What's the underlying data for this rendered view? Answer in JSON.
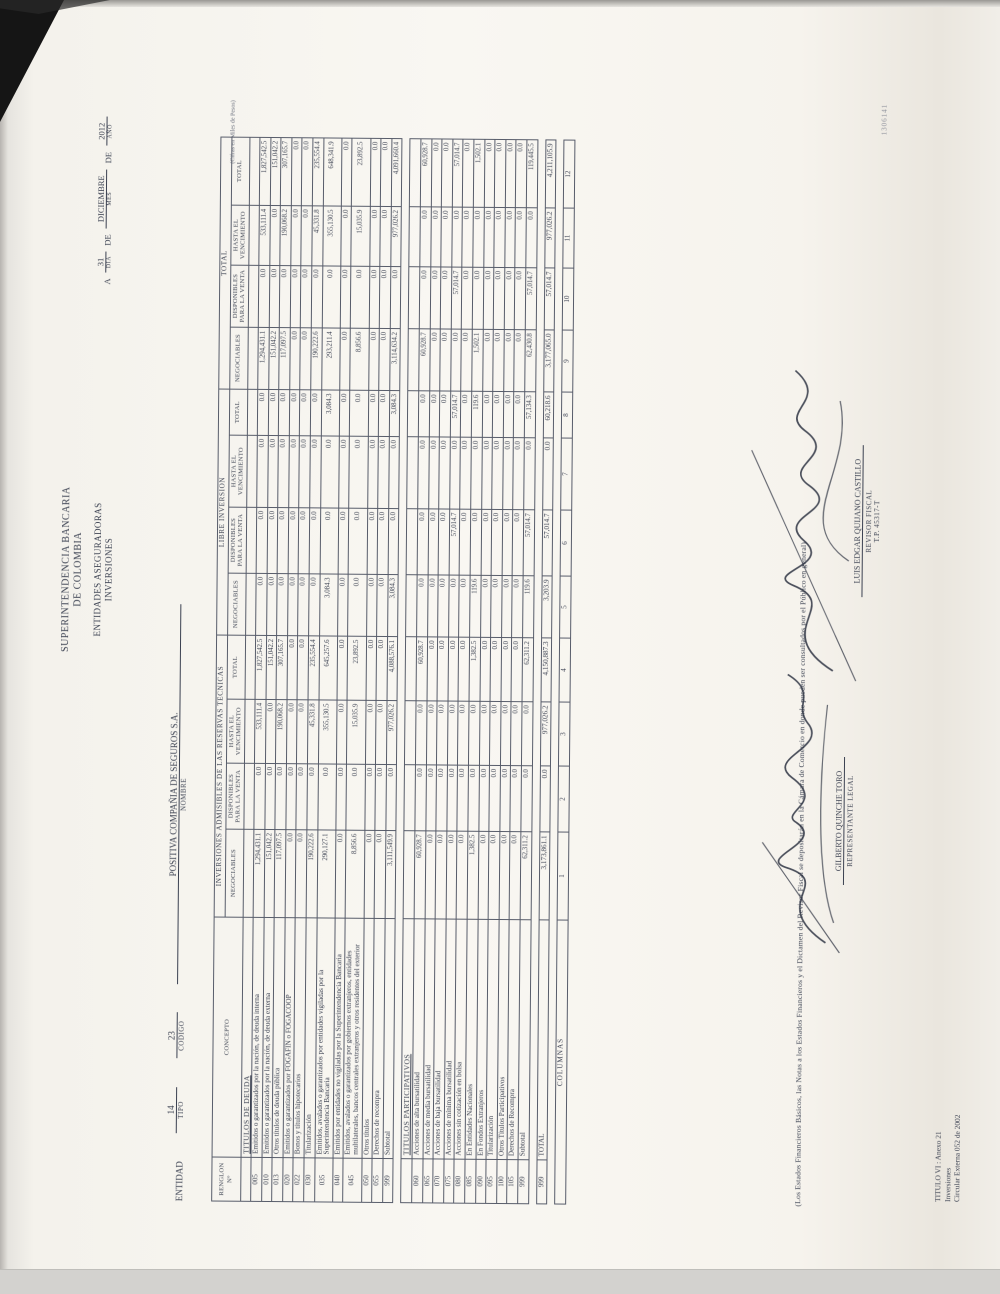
{
  "colors": {
    "ink": "#3a4050",
    "paper": "#f9f7f2"
  },
  "header": {
    "authority_line1": "SUPERINTENDENCIA BANCARIA",
    "authority_line2": "DE COLOMBIA",
    "subtitle1": "ENTIDADES ASEGURADORAS",
    "subtitle2": "INVERSIONES",
    "date": {
      "prefix": "A",
      "day": "31",
      "de1": "DE",
      "month": "DICIEMBRE",
      "de2": "DE",
      "year": "2012",
      "day_label": "DIA",
      "month_label": "MES",
      "year_label": "AÑO"
    },
    "entity": {
      "entidad_label": "ENTIDAD",
      "tipo_label": "TIPO",
      "tipo": "14",
      "codigo_label": "CODIGO",
      "codigo": "23",
      "nombre": "POSITIVA COMPAÑIA DE SEGUROS S.A.",
      "nombre_label": "NOMBRE"
    }
  },
  "table": {
    "renglon_header": "RENGLON N°",
    "concepto_header": "CONCEPTO",
    "units_note": "(Cifras en Miles de Pesos)",
    "groups": [
      {
        "label": "INVERSIONES ADMISIBLES DE LAS RESERVAS TECNICAS"
      },
      {
        "label": "LIBRE INVERSION"
      },
      {
        "label": "TOTAL"
      }
    ],
    "subheaders": [
      "NEGOCIABLES",
      "DISPONIBLES PARA LA VENTA",
      "HASTA EL VENCIMIENTO",
      "TOTAL",
      "NEGOCIABLES",
      "DISPONIBLES PARA LA VENTA",
      "HASTA EL VENCIMIENTO",
      "TOTAL",
      "NEGOCIABLES",
      "DISPONIBLES PARA LA VENTA",
      "HASTA EL VENCIMIENTO",
      "TOTAL"
    ],
    "sections": [
      {
        "title": "TITULOS DE DEUDA",
        "rows": [
          {
            "code": "005",
            "concept": "Emitidos o garantizados por la nación, de deuda interna",
            "values": [
              "1,294,431.1",
              "0.0",
              "533,111.4",
              "1,827,542.5",
              "0.0",
              "0.0",
              "0.0",
              "0.0",
              "1,294,431.1",
              "0.0",
              "533,111.4",
              "1,827,542.5"
            ]
          },
          {
            "code": "010",
            "concept": "Emitidos o garantizados por la nación, de deuda externa",
            "values": [
              "151,042.2",
              "0.0",
              "0.0",
              "151,042.2",
              "0.0",
              "0.0",
              "0.0",
              "0.0",
              "151,042.2",
              "0.0",
              "0.0",
              "151,042.2"
            ]
          },
          {
            "code": "013",
            "concept": "Otros títulos de deuda pública",
            "values": [
              "117,097.5",
              "0.0",
              "190,068.2",
              "307,165.7",
              "0.0",
              "0.0",
              "0.0",
              "0.0",
              "117,097.5",
              "0.0",
              "190,068.2",
              "307,165.7"
            ]
          },
          {
            "code": "020",
            "concept": "Emitidos o garantizados por FOGAFIN o FOGACOOP",
            "values": [
              "0.0",
              "0.0",
              "0.0",
              "0.0",
              "0.0",
              "0.0",
              "0.0",
              "0.0",
              "0.0",
              "0.0",
              "0.0",
              "0.0"
            ]
          },
          {
            "code": "022",
            "concept": "Bonos y títulos hipotecarios",
            "values": [
              "0.0",
              "0.0",
              "0.0",
              "0.0",
              "0.0",
              "0.0",
              "0.0",
              "0.0",
              "0.0",
              "0.0",
              "0.0",
              "0.0"
            ]
          },
          {
            "code": "030",
            "concept": "Titularización",
            "values": [
              "190,222.6",
              "0.0",
              "45,331.8",
              "235,554.4",
              "0.0",
              "0.0",
              "0.0",
              "0.0",
              "190,222.6",
              "0.0",
              "45,331.8",
              "235,554.4"
            ]
          },
          {
            "code": "035",
            "concept": "Emitidos, avalados o garantizados por entidades vigiladas por la Superintendencia Bancaria",
            "values": [
              "290,127.1",
              "0.0",
              "355,130.5",
              "645,257.6",
              "3,084.3",
              "0.0",
              "0.0",
              "3,084.3",
              "293,211.4",
              "0.0",
              "355,130.5",
              "648,341.9"
            ]
          },
          {
            "code": "040",
            "concept": "Emitidos por entidades no vigiladas por la Superintendencia Bancaria",
            "values": [
              "0.0",
              "0.0",
              "0.0",
              "0.0",
              "0.0",
              "0.0",
              "0.0",
              "0.0",
              "0.0",
              "0.0",
              "0.0",
              "0.0"
            ]
          },
          {
            "code": "045",
            "concept": "Emitidos, avalados o garantizados por gobiernos extranjeros, entidades multilaterales, bancos centrales extranjeros y otros residentes del exterior",
            "values": [
              "8,856.6",
              "0.0",
              "15,035.9",
              "23,892.5",
              "0.0",
              "0.0",
              "0.0",
              "0.0",
              "8,856.6",
              "0.0",
              "15,035.9",
              "23,892.5"
            ]
          },
          {
            "code": "050",
            "concept": "Otros títulos",
            "values": [
              "0.0",
              "0.0",
              "0.0",
              "0.0",
              "0.0",
              "0.0",
              "0.0",
              "0.0",
              "0.0",
              "0.0",
              "0.0",
              "0.0"
            ]
          },
          {
            "code": "055",
            "concept": "Derechos de recompra",
            "values": [
              "0.0",
              "0.0",
              "0.0",
              "0.0",
              "0.0",
              "0.0",
              "0.0",
              "0.0",
              "0.0",
              "0.0",
              "0.0",
              "0.0"
            ]
          },
          {
            "code": "999",
            "concept": "Subtotal",
            "subtotal": true,
            "values": [
              "3,111,549.9",
              "0.0",
              "977,026.2",
              "4,088,576.1",
              "3,084.3",
              "0.0",
              "0.0",
              "3,084.3",
              "3,114,634.2",
              "0.0",
              "977,026.2",
              "4,091,660.4"
            ]
          }
        ]
      },
      {
        "title": "TITULOS PARTICIPATIVOS",
        "rows": [
          {
            "code": "060",
            "concept": "Acciones de alta bursatilidad",
            "values": [
              "60,928.7",
              "0.0",
              "0.0",
              "60,928.7",
              "0.0",
              "0.0",
              "0.0",
              "0.0",
              "60,928.7",
              "0.0",
              "0.0",
              "60,928.7"
            ]
          },
          {
            "code": "065",
            "concept": "Acciones de media bursatilidad",
            "values": [
              "0.0",
              "0.0",
              "0.0",
              "0.0",
              "0.0",
              "0.0",
              "0.0",
              "0.0",
              "0.0",
              "0.0",
              "0.0",
              "0.0"
            ]
          },
          {
            "code": "070",
            "concept": "Acciones de baja bursatilidad",
            "values": [
              "0.0",
              "0.0",
              "0.0",
              "0.0",
              "0.0",
              "0.0",
              "0.0",
              "0.0",
              "0.0",
              "0.0",
              "0.0",
              "0.0"
            ]
          },
          {
            "code": "075",
            "concept": "Acciones de mínima bursatilidad",
            "values": [
              "0.0",
              "0.0",
              "0.0",
              "0.0",
              "0.0",
              "57,014.7",
              "0.0",
              "57,014.7",
              "0.0",
              "57,014.7",
              "0.0",
              "57,014.7"
            ]
          },
          {
            "code": "080",
            "concept": "Acciones sin cotización en bolsa",
            "values": [
              "0.0",
              "0.0",
              "0.0",
              "0.0",
              "0.0",
              "0.0",
              "0.0",
              "0.0",
              "0.0",
              "0.0",
              "0.0",
              "0.0"
            ]
          },
          {
            "code": "085",
            "concept": "En Entidades Nacionales",
            "values": [
              "1,382.5",
              "0.0",
              "0.0",
              "1,382.5",
              "119.6",
              "0.0",
              "0.0",
              "119.6",
              "1,502.1",
              "0.0",
              "0.0",
              "1,502.1"
            ]
          },
          {
            "code": "090",
            "concept": "En Fondos Extranjeros",
            "values": [
              "0.0",
              "0.0",
              "0.0",
              "0.0",
              "0.0",
              "0.0",
              "0.0",
              "0.0",
              "0.0",
              "0.0",
              "0.0",
              "0.0"
            ]
          },
          {
            "code": "095",
            "concept": "Titularización",
            "values": [
              "0.0",
              "0.0",
              "0.0",
              "0.0",
              "0.0",
              "0.0",
              "0.0",
              "0.0",
              "0.0",
              "0.0",
              "0.0",
              "0.0"
            ]
          },
          {
            "code": "100",
            "concept": "Otros Títulos Participativos",
            "values": [
              "0.0",
              "0.0",
              "0.0",
              "0.0",
              "0.0",
              "0.0",
              "0.0",
              "0.0",
              "0.0",
              "0.0",
              "0.0",
              "0.0"
            ]
          },
          {
            "code": "105",
            "concept": "Derechos de Recompra",
            "values": [
              "0.0",
              "0.0",
              "0.0",
              "0.0",
              "0.0",
              "0.0",
              "0.0",
              "0.0",
              "0.0",
              "0.0",
              "0.0",
              "0.0"
            ]
          },
          {
            "code": "999",
            "concept": "Subtotal",
            "subtotal": true,
            "values": [
              "62,311.2",
              "0.0",
              "0.0",
              "62,311.2",
              "119.6",
              "57,014.7",
              "0.0",
              "57,134.3",
              "62,430.8",
              "57,014.7",
              "0.0",
              "119,445.5"
            ]
          }
        ]
      }
    ],
    "total_row": {
      "code": "999",
      "label": "TOTAL",
      "values": [
        "3,173,861.1",
        "0.0",
        "977,026.2",
        "4,150,887.3",
        "3,203.9",
        "57,014.7",
        "0.0",
        "60,218.6",
        "3,177,065.0",
        "57,014.7",
        "977,026.2",
        "4,211,105.9"
      ]
    },
    "columnas": {
      "label": "COLUMNAS",
      "numbers": [
        "1",
        "2",
        "3",
        "4",
        "5",
        "6",
        "7",
        "8",
        "9",
        "10",
        "11",
        "12"
      ]
    }
  },
  "footer": {
    "footnote": "(Los Estados Financieros Básicos, las Notas a los Estados Financieros y el Dictamen del Revisor Fiscal se depositarán en la Cámara de Comercio en donde pueden ser consultados por el Público en general)",
    "annex_line1": "TITULO VI : Anexo 21",
    "annex_line2": "Inversiones",
    "annex_line3": "Circular Externa 052 de 2002",
    "signature1": {
      "name": "GILBERTO QUINCHE TORO",
      "role": "REPRESENTANTE LEGAL"
    },
    "signature2": {
      "name": "LUIS EDGAR QUIJANO CASTILLO",
      "role": "REVISOR FISCAL",
      "tp": "T.P. 45317-T"
    },
    "stamp_number": "1306141"
  }
}
